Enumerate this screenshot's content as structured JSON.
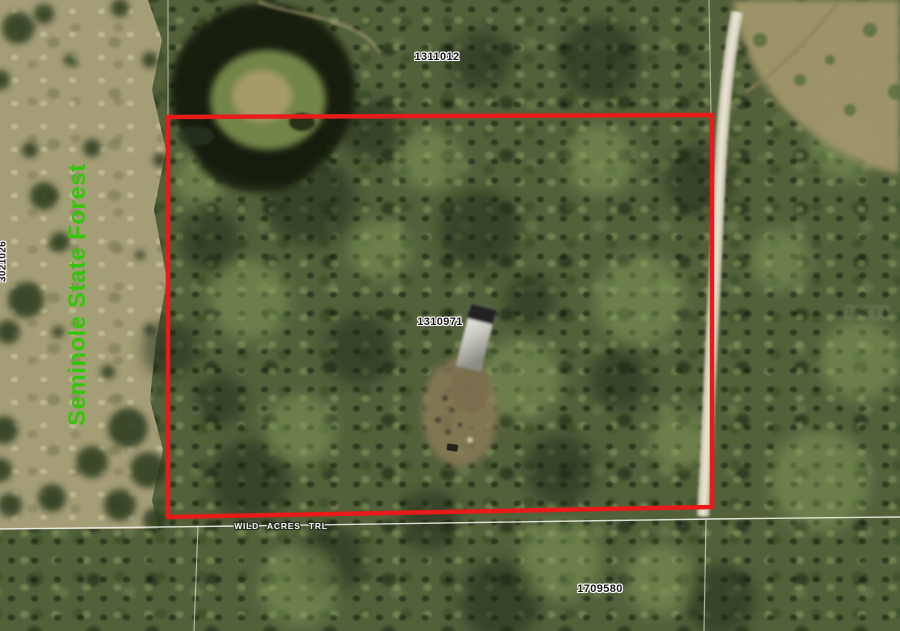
{
  "map": {
    "type": "aerial-parcel-view",
    "boundary_color": "#e81a1a",
    "labels": {
      "parcel_top": "1311012",
      "parcel_center": "1310971",
      "parcel_bottom_right": "1709580",
      "parcel_left_edge_partial": "3021026",
      "road": "WILD ACRES TRL",
      "area": "Seminole State Forest",
      "area_color": "#38c40c"
    }
  }
}
